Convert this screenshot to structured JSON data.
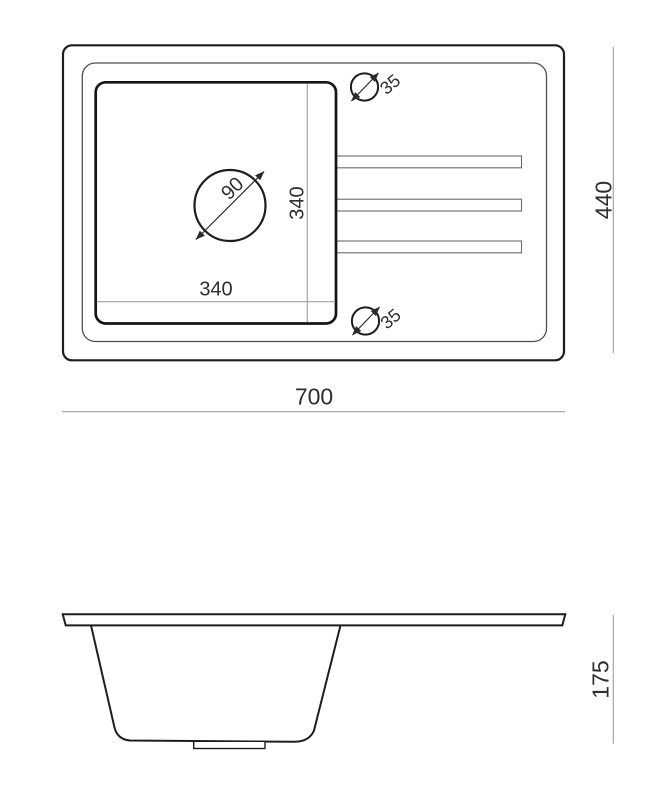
{
  "colors": {
    "background": "#ffffff",
    "primary_line": "#1e1e1e",
    "bowl_line": "#141414",
    "rim_line": "#4f4f4f",
    "dimension_line": "#a3a3a3",
    "ridge_line": "#6a6a6a",
    "label_text": "#2e2e2e"
  },
  "top_view": {
    "overall_width": "700",
    "overall_depth": "440",
    "bowl_width": "340",
    "bowl_depth": "340",
    "drain_diameter": "90",
    "tap_hole_top": "35",
    "tap_hole_bottom": "35"
  },
  "side_view": {
    "depth": "175"
  }
}
